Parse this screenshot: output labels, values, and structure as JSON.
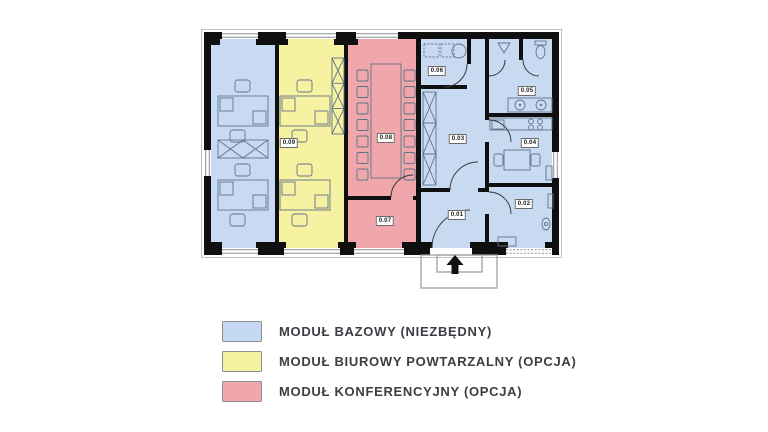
{
  "plan": {
    "colors": {
      "base": "#c8daf2",
      "office": "#f6f2a2",
      "conference": "#efa7ac"
    },
    "rooms": [
      {
        "id": "0.01"
      },
      {
        "id": "0.02"
      },
      {
        "id": "0.03"
      },
      {
        "id": "0.04"
      },
      {
        "id": "0.05"
      },
      {
        "id": "0.06"
      },
      {
        "id": "0.07"
      },
      {
        "id": "0.08"
      },
      {
        "id": "0.09"
      }
    ]
  },
  "legend": {
    "items": [
      {
        "label": "MODUŁ BAZOWY (NIEZBĘDNY)",
        "color": "#c5d9f2"
      },
      {
        "label": "MODUŁ BIUROWY POWTARZALNY (OPCJA)",
        "color": "#f6f2a2"
      },
      {
        "label": "MODUŁ KONFERENCYJNY (OPCJA)",
        "color": "#efa7ac"
      }
    ]
  }
}
